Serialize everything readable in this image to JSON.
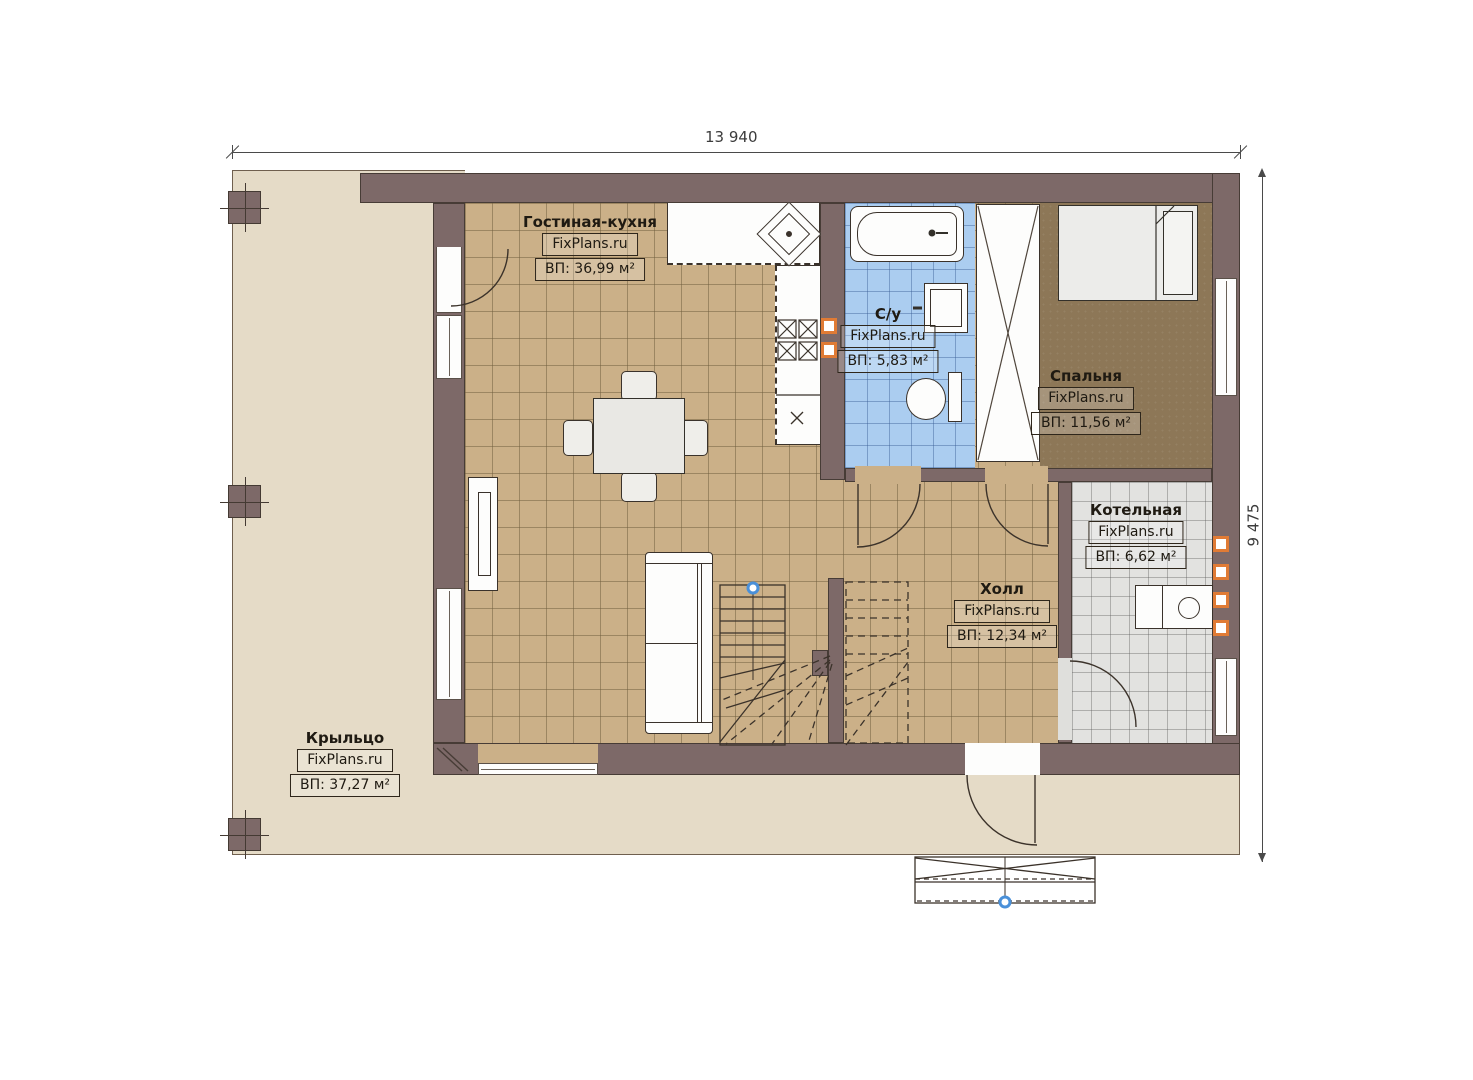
{
  "dimensions": {
    "top": "13 940",
    "right": "9 475"
  },
  "rooms": [
    {
      "name": "Гостиная-кухня",
      "watermark": "FixPlans.ru",
      "area": "ВП: 36,99 м²"
    },
    {
      "name": "С/у",
      "watermark": "FixPlans.ru",
      "area": "ВП: 5,83 м²"
    },
    {
      "name": "Спальня",
      "watermark": "FixPlans.ru",
      "area": "ВП: 11,56 м²"
    },
    {
      "name": "Котельная",
      "watermark": "FixPlans.ru",
      "area": "ВП: 6,62 м²"
    },
    {
      "name": "Холл",
      "watermark": "FixPlans.ru",
      "area": "ВП: 12,34 м²"
    },
    {
      "name": "Крыльцо",
      "watermark": "FixPlans.ru",
      "area": "ВП: 37,27 м²"
    }
  ],
  "colors": {
    "wall": "#7d6968",
    "floor_living_hall": "#cbb088",
    "floor_bathroom": "#abcdf0",
    "floor_bedroom": "#8d7757",
    "floor_boiler": "#e2e2e0",
    "porch": "#e5dbc7",
    "vent_accent": "#e07b35",
    "marker_blue": "#4a90d9"
  }
}
